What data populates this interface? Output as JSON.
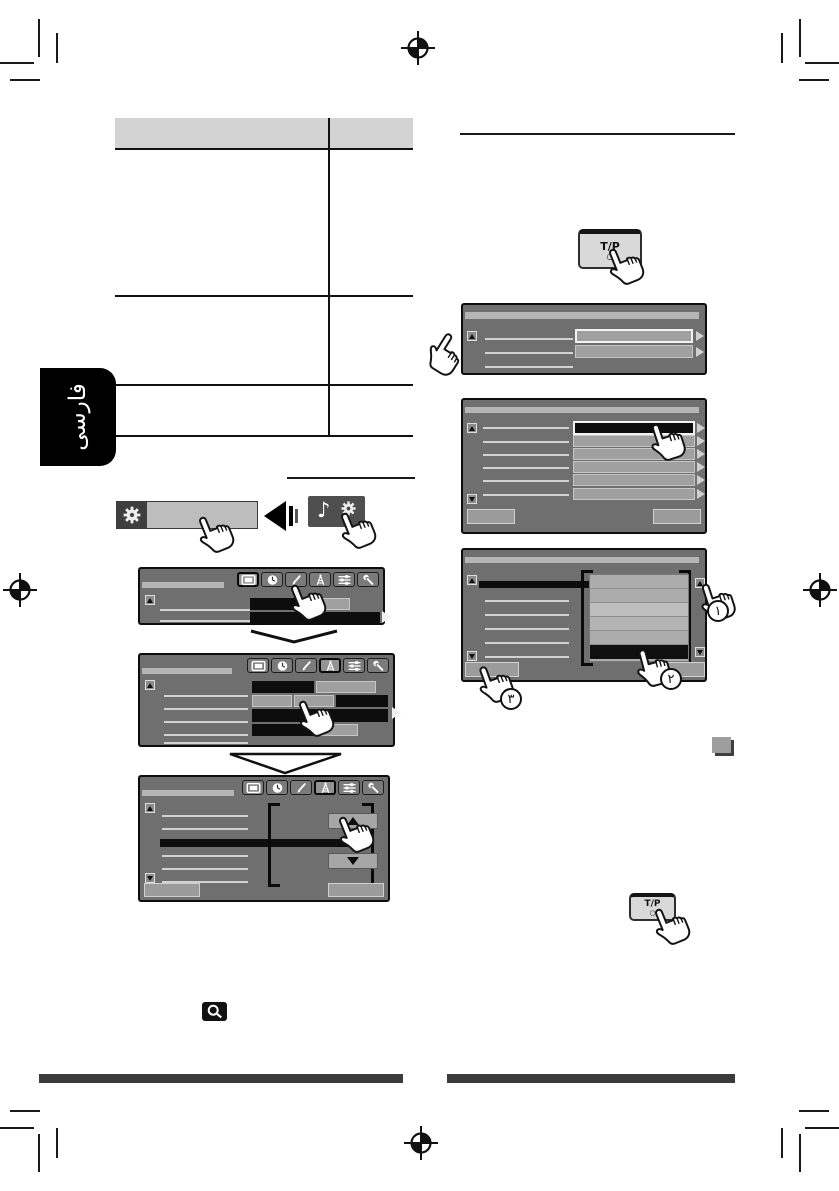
{
  "language_tab": {
    "label": "فارسی"
  },
  "tp_button": {
    "label": "T/P",
    "indicator_dot": "○"
  },
  "step_badges": {
    "step_1": "١",
    "step_2": "٢",
    "step_3": "٣"
  },
  "glyphs": {
    "music_note": "♪"
  },
  "icons": {
    "gear": "gear-icon",
    "music_settings": "music-note-gear-icon",
    "display_tab": "monitor-icon",
    "clock_tab": "clock-icon",
    "color_tab": "brush-icon",
    "tuner_tab": "antenna-icon",
    "audio_tab": "equalizer-icon",
    "settings_tab": "wrench-icon",
    "magnifier": "magnifier-icon",
    "hand": "pointing-hand-icon",
    "registration": "registration-mark",
    "scroll_up": "up-arrow",
    "scroll_down": "down-arrow"
  },
  "colors": {
    "screen_background": "#6f6f6f",
    "screen_header_strip": "#b5b5b5",
    "highlight_black": "#0d0d0d",
    "value_box_gray": "#a0a0a0",
    "table_header": "#d3d3d3",
    "footer_bar": "#3b3b3b",
    "tp_button_face": "#d9d9d9",
    "language_tab_bg": "#000000"
  }
}
